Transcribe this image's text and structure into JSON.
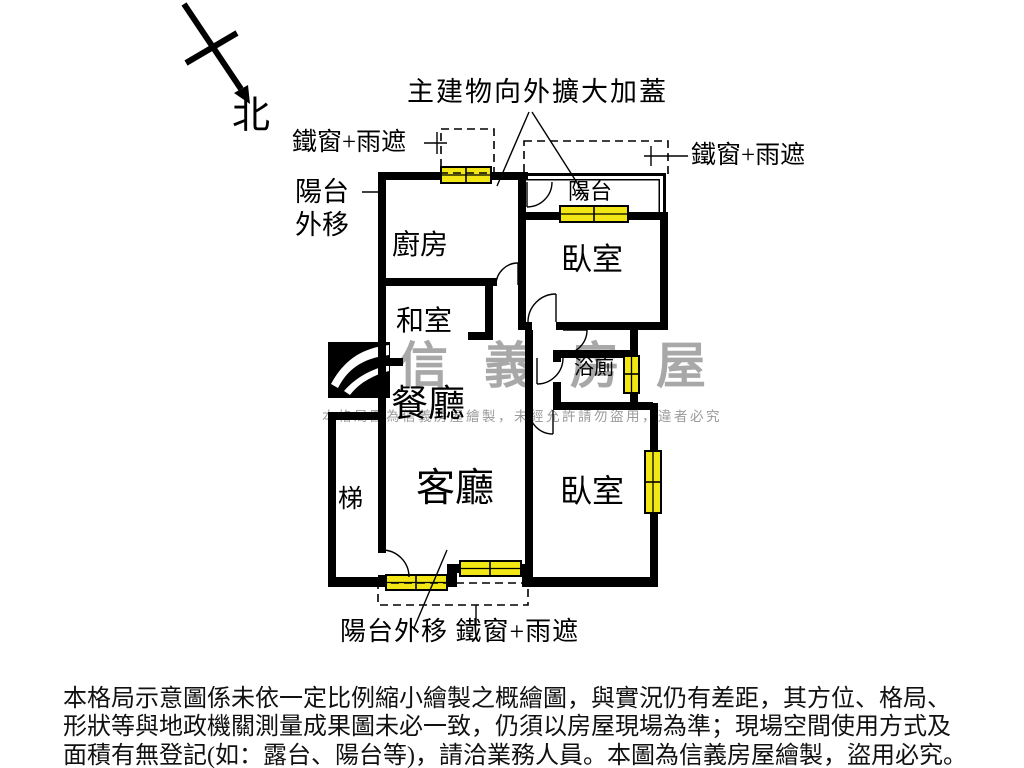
{
  "compass": {
    "north": "北"
  },
  "annotations": {
    "main_building_expansion": "主建物向外擴大加蓋",
    "iron_window_left": "鐵窗+雨遮",
    "iron_window_right": "鐵窗+雨遮",
    "balcony_moved_line1": "陽台",
    "balcony_moved_line2": "外移",
    "bottom_note": "陽台外移 鐵窗+雨遮"
  },
  "rooms": {
    "kitchen": "廚房",
    "balcony": "陽台",
    "bedroom_top": "臥室",
    "tatami": "和室",
    "dining": "餐廳",
    "bath": "浴廁",
    "living": "客廳",
    "bedroom_bottom": "臥室",
    "stairs": "梯"
  },
  "watermark": {
    "brand": "信義房屋",
    "notice": "本格局圖為信義房屋繪製，未經允許請勿盜用，違者必究"
  },
  "disclaimer": {
    "line1": "本格局示意圖係未依一定比例縮小繪製之概繪圖，與實況仍有差距，其方位、格局、",
    "line2": "形狀等與地政機關測量成果圖未必一致，仍須以房屋現場為準；現場空間使用方式及",
    "line3": "面積有無登記(如：露台、陽台等)，請洽業務人員。本圖為信義房屋繪製，盜用必究。"
  },
  "colors": {
    "wall": "#000000",
    "window_fill": "#f2e715",
    "watermark_gray": "#a8a8a8",
    "notice_gray": "#9b9b9b"
  }
}
